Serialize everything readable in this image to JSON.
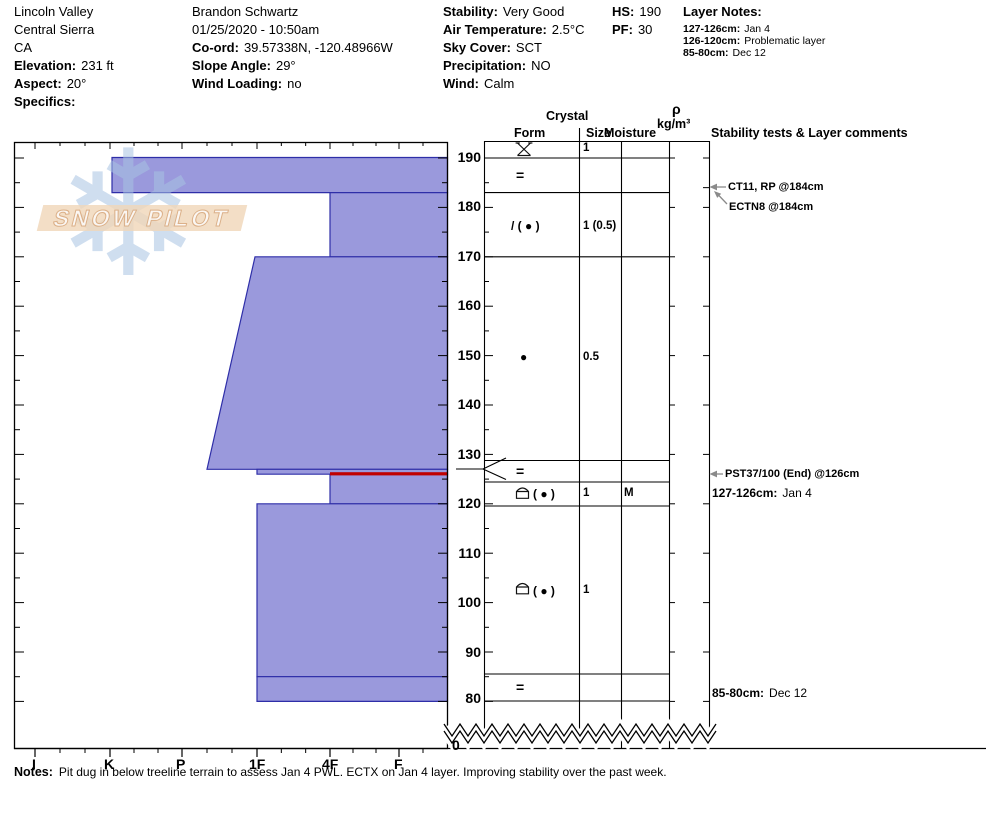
{
  "header": {
    "site": {
      "lines": [
        "Lincoln Valley",
        "Central Sierra",
        "CA"
      ],
      "fields": [
        {
          "label": "Elevation:",
          "value": "231 ft"
        },
        {
          "label": "Aspect:",
          "value": "20°"
        },
        {
          "label": "Specifics:",
          "value": ""
        }
      ]
    },
    "observer": {
      "lines": [
        "Brandon Schwartz",
        "01/25/2020 - 10:50am"
      ],
      "fields": [
        {
          "label": "Co-ord:",
          "value": "39.57338N, -120.48966W"
        },
        {
          "label": "Slope Angle:",
          "value": "29°"
        },
        {
          "label": "Wind Loading:",
          "value": "no"
        }
      ]
    },
    "conditions": {
      "fields": [
        {
          "label": "Stability:",
          "value": "Very Good"
        },
        {
          "label": "Air Temperature:",
          "value": "2.5°C"
        },
        {
          "label": "Sky Cover:",
          "value": "SCT"
        },
        {
          "label": "Precipitation:",
          "value": "NO"
        },
        {
          "label": "Wind:",
          "value": "Calm"
        }
      ]
    },
    "totals": {
      "hs_label": "HS:",
      "hs": "190",
      "pf_label": "PF:",
      "pf": "30"
    },
    "layer_notes": {
      "title": "Layer Notes:",
      "entries": [
        {
          "range": "127-126cm:",
          "note": "Jan 4"
        },
        {
          "range": "126-120cm:",
          "note": "Problematic layer"
        },
        {
          "range": "85-80cm:",
          "note": "Dec 12"
        }
      ]
    }
  },
  "watermark": {
    "text": "SNOW PILOT",
    "snowflake_icon": "snowflake"
  },
  "axes": {
    "hardness_labels": [
      "I",
      "K",
      "P",
      "1F",
      "4F",
      "F"
    ],
    "depth_labels": [
      "190",
      "180",
      "170",
      "160",
      "150",
      "140",
      "130",
      "120",
      "110",
      "100",
      "90",
      "80"
    ],
    "ground_label": "0"
  },
  "columns": {
    "crystal": "Crystal",
    "form": "Form",
    "size": "Size",
    "moisture": "Moisture",
    "rho": "ρ",
    "rho_units": "kg/m³",
    "comments": "Stability tests & Layer comments"
  },
  "grain_rows": [
    {
      "form_icon": "stellar-graupel",
      "form_text": "",
      "size": "1",
      "moisture": ""
    },
    {
      "form_icon": "ice-lens",
      "form_text": "=",
      "size": "",
      "moisture": ""
    },
    {
      "form_icon": "decomposing-rounds",
      "form_text": "/ ( ● )",
      "size": "1 (0.5)",
      "moisture": ""
    },
    {
      "form_icon": "rounded-grains",
      "form_text": "●",
      "size": "0.5",
      "moisture": ""
    },
    {
      "form_icon": "ice-lens",
      "form_text": "=",
      "size": "",
      "moisture": ""
    },
    {
      "form_icon": "facets-rounding",
      "form_text": "( ● )",
      "size": "1",
      "moisture": "M"
    },
    {
      "form_icon": "facets-rounding",
      "form_text": "( ● )",
      "size": "1",
      "moisture": ""
    },
    {
      "form_icon": "ice-lens",
      "form_text": "=",
      "size": "",
      "moisture": ""
    }
  ],
  "test_annotations": [
    {
      "text": "CT11, RP @184cm"
    },
    {
      "text": "ECTN8 @184cm"
    },
    {
      "text": "PST37/100 (End) @126cm"
    }
  ],
  "layer_comments": [
    {
      "range": "127-126cm:",
      "note": "Jan 4"
    },
    {
      "range": "85-80cm:",
      "note": "Dec 12"
    }
  ],
  "notes": {
    "label": "Notes:",
    "text": "Pit dug in below treeline terrain to assess Jan 4 PWL. ECTX on Jan 4 layer. Improving stability over the past week."
  },
  "colors": {
    "layer_fill": "#9a99dc",
    "layer_border": "#2e2ea8",
    "flag_red": "#c00000",
    "arrow_gray": "#8a8a8a",
    "watermark_blue": "#a8c3e2",
    "watermark_tan": "#f0d6b8"
  },
  "chart_data": {
    "type": "bar",
    "title": "Snow pit hardness profile (SnowPilot)",
    "xlabel": "Hand hardness",
    "x_categories": [
      "I",
      "K",
      "P",
      "1F",
      "4F",
      "F"
    ],
    "ylabel": "Depth (cm)",
    "depth_axis_top_cm": 190,
    "depth_axis_bottom_cm": 80,
    "ground_cm": 0,
    "hs_cm": 190,
    "pf": 30,
    "hardness_layers": [
      {
        "top_cm": 190,
        "bottom_cm": 183,
        "hardness": "K"
      },
      {
        "top_cm": 183,
        "bottom_cm": 170,
        "hardness": "4F"
      },
      {
        "top_cm": 170,
        "bottom_cm": 127,
        "hardness_top": "1F",
        "hardness_bottom": "P-1F"
      },
      {
        "top_cm": 127,
        "bottom_cm": 126,
        "hardness": "1F"
      },
      {
        "top_cm": 126,
        "bottom_cm": 120,
        "hardness": "4F",
        "flagged_red": true
      },
      {
        "top_cm": 120,
        "bottom_cm": 85,
        "hardness": "1F"
      },
      {
        "top_cm": 85,
        "bottom_cm": 80,
        "hardness": "1F"
      }
    ],
    "grain_layers": [
      {
        "top_cm": 190,
        "bottom_cm": 188,
        "form": "PP stellar + graupel",
        "size_mm": "1"
      },
      {
        "top_cm": 188,
        "bottom_cm": 183,
        "form": "ice lens (=)"
      },
      {
        "top_cm": 183,
        "bottom_cm": 170,
        "form": "DF ( RG )",
        "size_mm": "1 (0.5)"
      },
      {
        "top_cm": 170,
        "bottom_cm": 127,
        "form": "RG",
        "size_mm": "0.5"
      },
      {
        "top_cm": 127,
        "bottom_cm": 126,
        "form": "ice lens (=)"
      },
      {
        "top_cm": 126,
        "bottom_cm": 120,
        "form": "FCxr ( RG )",
        "size_mm": "1",
        "moisture": "M"
      },
      {
        "top_cm": 120,
        "bottom_cm": 85,
        "form": "FCxr ( RG )",
        "size_mm": "1"
      },
      {
        "top_cm": 85,
        "bottom_cm": 80,
        "form": "ice lens (=)"
      }
    ],
    "tests": [
      {
        "result": "CT11, RP",
        "depth_cm": 184
      },
      {
        "result": "ECTN8",
        "depth_cm": 184
      },
      {
        "result": "PST37/100 (End)",
        "depth_cm": 126
      }
    ],
    "legend_position": "none",
    "grid": false
  }
}
